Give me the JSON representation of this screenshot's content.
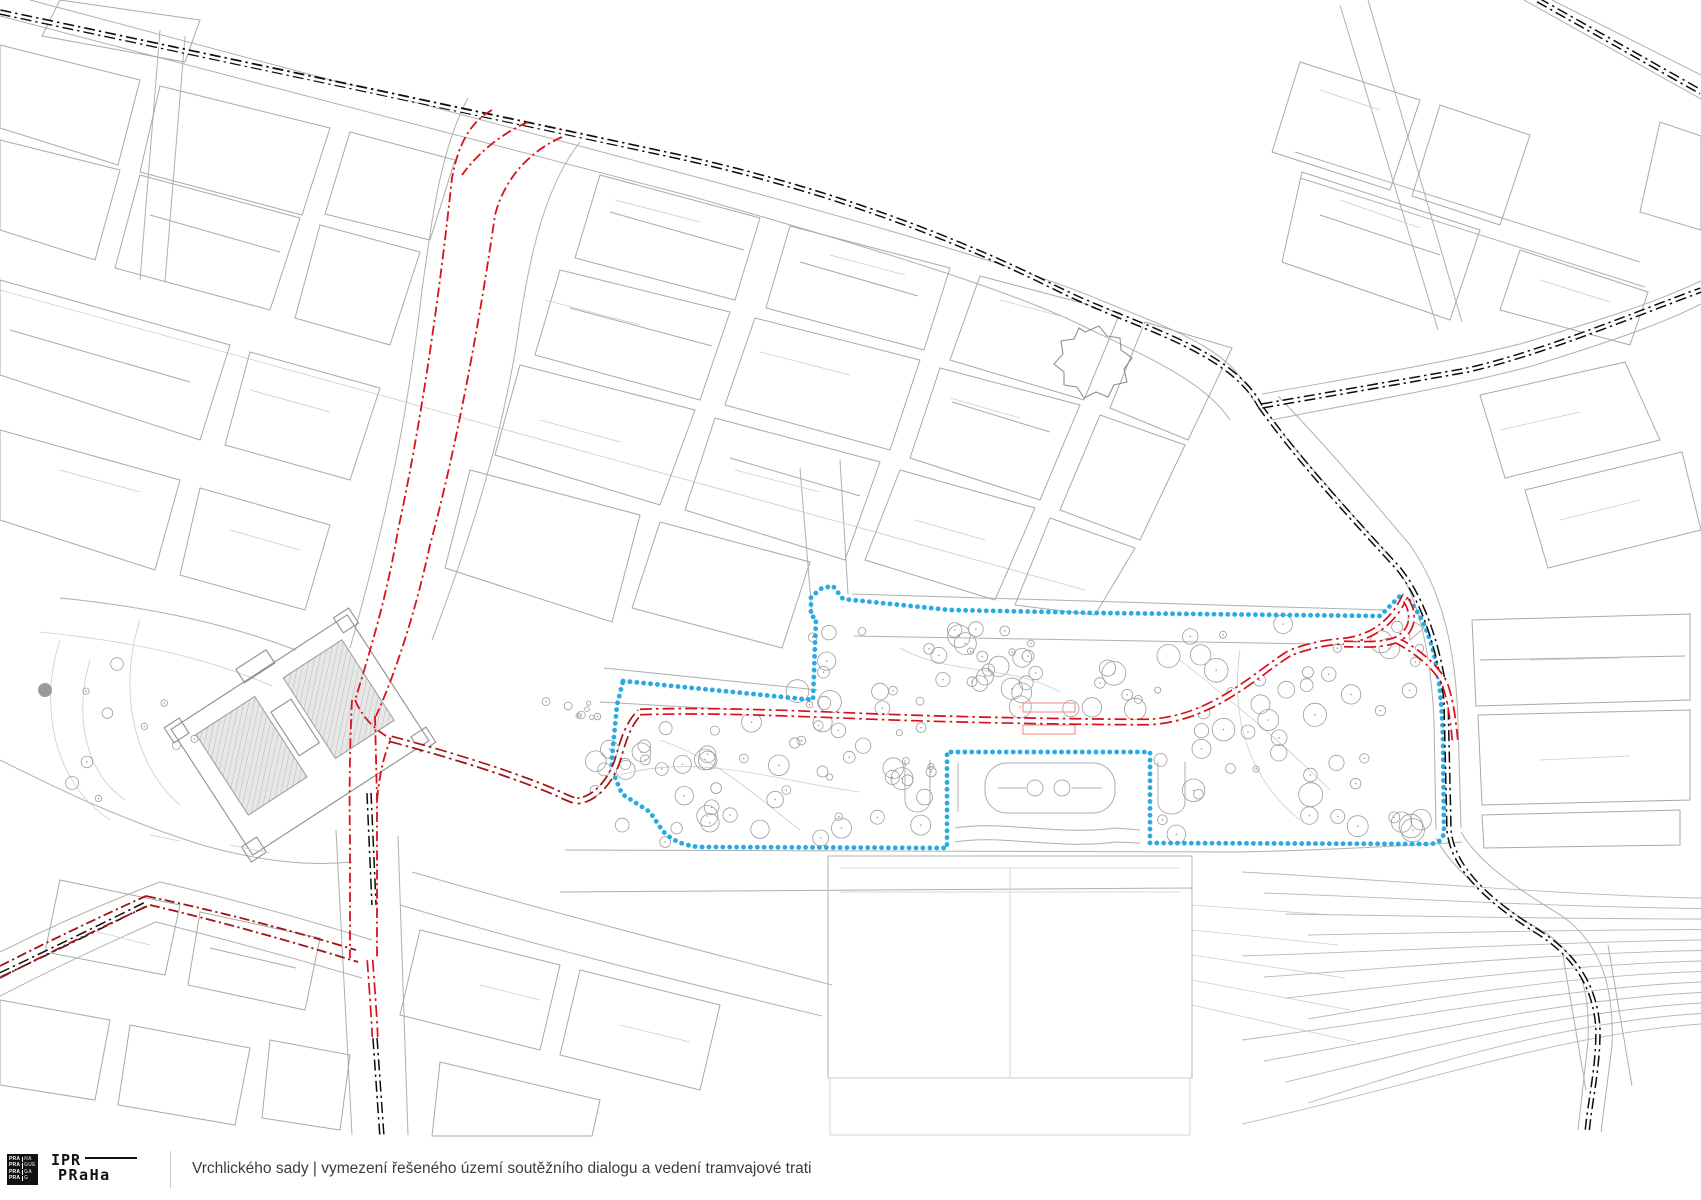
{
  "footer": {
    "logo": {
      "square_rows": [
        [
          "PRA",
          "HA"
        ],
        [
          "PRA",
          "GUE"
        ],
        [
          "PRA",
          "GA"
        ],
        [
          "PRA",
          "G"
        ]
      ],
      "wordmark_line1": "IPR",
      "wordmark_line2": "PRaHa"
    },
    "title": "Vrchlického sady | vymezení řešeného území soutěžního dialogu a vedení tramvajové trati"
  },
  "colors": {
    "existing-tram": "#0d0d0d",
    "proposed-tram": "#d8111b",
    "proposed-tram-dark": "#a31114",
    "study-boundary": "#29abe2",
    "stop-platform": "#f29a9a",
    "base-map-line": "#b0b0b0",
    "background": "#ffffff"
  }
}
